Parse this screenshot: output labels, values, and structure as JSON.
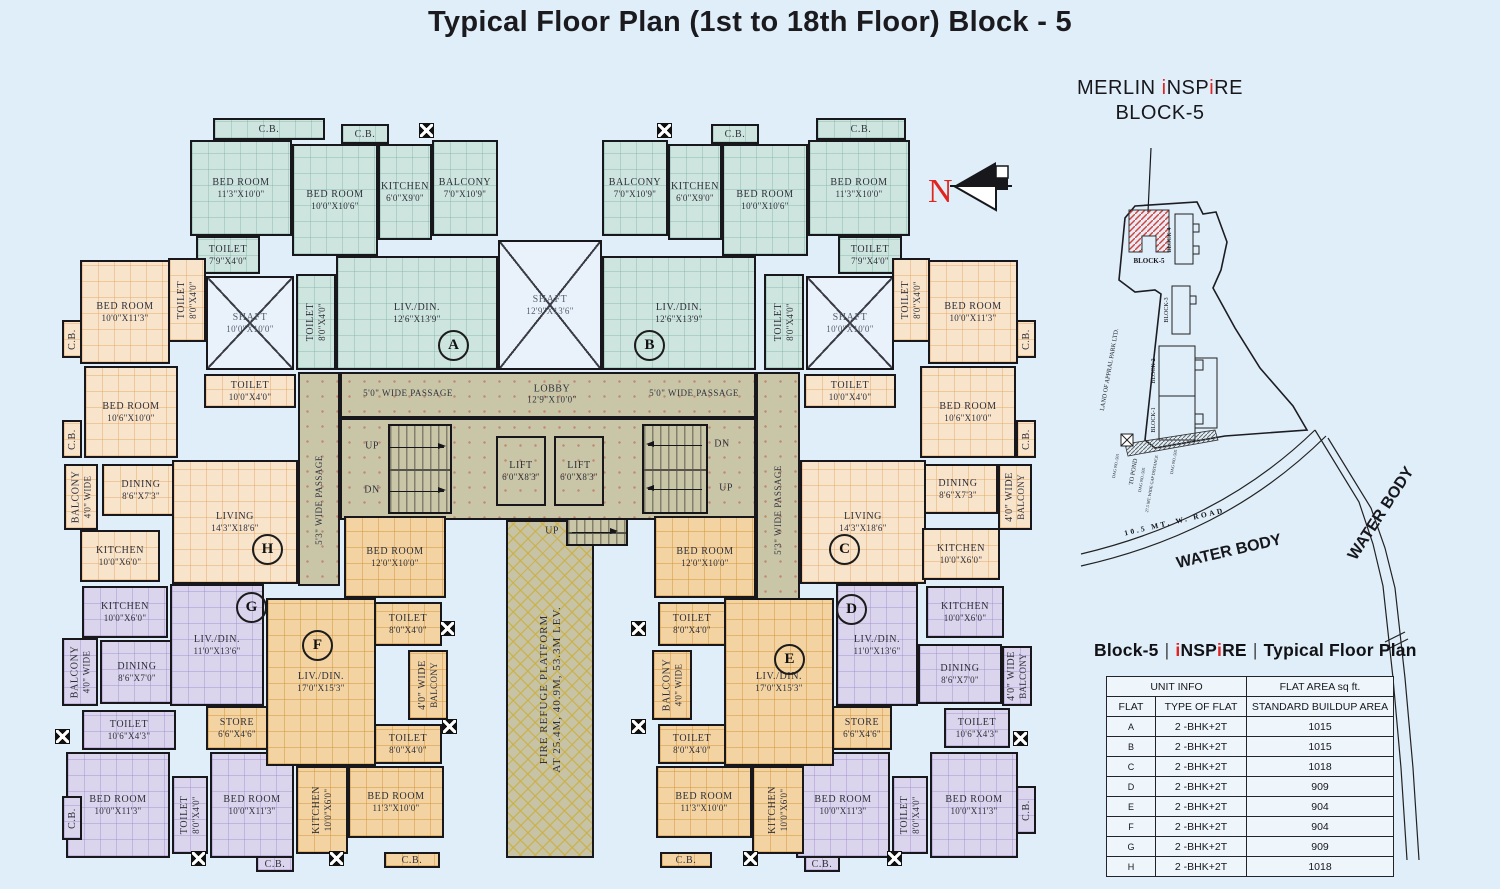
{
  "title": "Typical Floor Plan (1st to 18th Floor) Block - 5",
  "colors": {
    "background": "#dfeef9",
    "flat_ab_teal": "#cde5de",
    "flat_hc_peach": "#f8e4cb",
    "flat_gd_lavender": "#dad4ec",
    "flat_fe_orange": "#f3d3a1",
    "corridor_olive": "#c9c6a8",
    "shaft_blue": "#e9f2fa",
    "wall_black": "#17171c",
    "accent_red": "#e02420"
  },
  "north": {
    "label": "N"
  },
  "project": {
    "name_pre": "MERLIN ",
    "i1": "i",
    "m": "NSP",
    "i2": "i",
    "e": "RE",
    "line2": "BLOCK-5"
  },
  "legend_heading": {
    "left": "Block-5",
    "sep": "|",
    "i1": "i",
    "m": "NSP",
    "i2": "i",
    "e": "RE",
    "right": "Typical Floor Plan"
  },
  "legend_table": {
    "h1a": "UNIT INFO",
    "h1b": "FLAT AREA sq ft.",
    "h2a": "FLAT",
    "h2b": "TYPE OF FLAT",
    "h2c": "STANDARD BUILDUP AREA",
    "rows": [
      {
        "f": "A",
        "t": "2 -BHK+2T",
        "a": "1015"
      },
      {
        "f": "B",
        "t": "2 -BHK+2T",
        "a": "1015"
      },
      {
        "f": "C",
        "t": "2 -BHK+2T",
        "a": "1018"
      },
      {
        "f": "D",
        "t": "2 -BHK+2T",
        "a": "909"
      },
      {
        "f": "E",
        "t": "2 -BHK+2T",
        "a": "904"
      },
      {
        "f": "F",
        "t": "2 -BHK+2T",
        "a": "904"
      },
      {
        "f": "G",
        "t": "2 -BHK+2T",
        "a": "909"
      },
      {
        "f": "H",
        "t": "2 -BHK+2T",
        "a": "1018"
      }
    ]
  },
  "sitemap": {
    "block5": "BLOCK-5",
    "block4": "BLOCK-4",
    "block3": "BLOCK-3",
    "block2": "BLOCK-2",
    "block1": "BLOCK-1",
    "land": "LAND OF APPRAL PARK LTD.",
    "to_pond": "TO POND",
    "dag1": "DAG NO.-501",
    "dag2": "DAG NO.-505",
    "gap": "27.5 MT. WIDE GAP DISTANCE",
    "dag3": "DAG NO.-505",
    "road": "10.5 MT. W. ROAD",
    "water1": "WATER BODY",
    "water2": "WATER BODY"
  },
  "plan": {
    "rooms": [
      {
        "n": "",
        "x": 298,
        "y": 372,
        "w": 42,
        "h": 214,
        "c": "g"
      },
      {
        "n": "",
        "x": 756,
        "y": 372,
        "w": 44,
        "h": 252,
        "c": "g"
      },
      {
        "n": "",
        "x": 340,
        "y": 372,
        "w": 416,
        "h": 46,
        "c": "g"
      },
      {
        "n": "",
        "x": 340,
        "y": 418,
        "w": 416,
        "h": 102,
        "c": "g"
      },
      {
        "n": "FIRE REFUGE PLATFORM",
        "d": "AT 25.4M, 40.9M, 53.3M LEV.",
        "x": 506,
        "y": 520,
        "w": 88,
        "h": 338,
        "c": "fire",
        "v": 1
      },
      {
        "n": "LIFT",
        "d": "6'0\"X8'3\"",
        "x": 496,
        "y": 436,
        "w": 50,
        "h": 70,
        "c": "g"
      },
      {
        "n": "LIFT",
        "d": "6'0\"X8'3\"",
        "x": 554,
        "y": 436,
        "w": 50,
        "h": 70,
        "c": "g"
      },
      {
        "n": "C.B.",
        "x": 213,
        "y": 118,
        "w": 112,
        "h": 22,
        "c": "t"
      },
      {
        "n": "BED ROOM",
        "d": "11'3\"X10'0\"",
        "x": 190,
        "y": 140,
        "w": 102,
        "h": 96,
        "c": "t"
      },
      {
        "n": "C.B.",
        "x": 341,
        "y": 124,
        "w": 48,
        "h": 20,
        "c": "t"
      },
      {
        "n": "BED ROOM",
        "d": "10'0\"X10'6\"",
        "x": 292,
        "y": 144,
        "w": 86,
        "h": 112,
        "c": "t"
      },
      {
        "n": "KITCHEN",
        "d": "6'0\"X9'0\"",
        "x": 378,
        "y": 144,
        "w": 54,
        "h": 96,
        "c": "t"
      },
      {
        "n": "BALCONY",
        "d": "7'0\"X10'9\"",
        "x": 432,
        "y": 140,
        "w": 66,
        "h": 96,
        "c": "t"
      },
      {
        "n": "TOILET",
        "d": "7'9\"X4'0\"",
        "x": 196,
        "y": 236,
        "w": 64,
        "h": 38,
        "c": "t"
      },
      {
        "n": "SHAFT",
        "d": "10'0\"X10'0\"",
        "x": 206,
        "y": 276,
        "w": 88,
        "h": 94,
        "c": "s"
      },
      {
        "n": "TOILET",
        "d": "8'0\"X4'0\"",
        "x": 296,
        "y": 274,
        "w": 40,
        "h": 96,
        "c": "t",
        "v": 1
      },
      {
        "n": "LIV./DIN.",
        "d": "12'6\"X13'9\"",
        "x": 336,
        "y": 256,
        "w": 162,
        "h": 114,
        "c": "t"
      },
      {
        "n": "BALCONY",
        "d": "7'0\"X10'9\"",
        "x": 602,
        "y": 140,
        "w": 66,
        "h": 96,
        "c": "t"
      },
      {
        "n": "KITCHEN",
        "d": "6'0\"X9'0\"",
        "x": 668,
        "y": 144,
        "w": 54,
        "h": 96,
        "c": "t"
      },
      {
        "n": "C.B.",
        "x": 711,
        "y": 124,
        "w": 48,
        "h": 20,
        "c": "t"
      },
      {
        "n": "BED ROOM",
        "d": "10'0\"X10'6\"",
        "x": 722,
        "y": 144,
        "w": 86,
        "h": 112,
        "c": "t"
      },
      {
        "n": "C.B.",
        "x": 816,
        "y": 118,
        "w": 90,
        "h": 22,
        "c": "t"
      },
      {
        "n": "BED ROOM",
        "d": "11'3\"X10'0\"",
        "x": 808,
        "y": 140,
        "w": 102,
        "h": 96,
        "c": "t"
      },
      {
        "n": "TOILET",
        "d": "7'9\"X4'0\"",
        "x": 838,
        "y": 236,
        "w": 64,
        "h": 38,
        "c": "t"
      },
      {
        "n": "SHAFT",
        "d": "10'0\"X10'0\"",
        "x": 806,
        "y": 276,
        "w": 88,
        "h": 94,
        "c": "s"
      },
      {
        "n": "TOILET",
        "d": "8'0\"X4'0\"",
        "x": 764,
        "y": 274,
        "w": 40,
        "h": 96,
        "c": "t",
        "v": 1
      },
      {
        "n": "LIV./DIN.",
        "d": "12'6\"X13'9\"",
        "x": 602,
        "y": 256,
        "w": 154,
        "h": 114,
        "c": "t"
      },
      {
        "n": "SHAFT",
        "d": "12'9\"X13'6\"",
        "x": 498,
        "y": 240,
        "w": 104,
        "h": 130,
        "c": "s"
      },
      {
        "n": "TOILET",
        "d": "8'0\"X4'0\"",
        "x": 168,
        "y": 258,
        "w": 38,
        "h": 84,
        "c": "p",
        "v": 1
      },
      {
        "n": "BED ROOM",
        "d": "10'0\"X11'3\"",
        "x": 80,
        "y": 260,
        "w": 90,
        "h": 104,
        "c": "p"
      },
      {
        "n": "C.B.",
        "x": 62,
        "y": 320,
        "w": 20,
        "h": 38,
        "c": "p",
        "v": 1
      },
      {
        "n": "BED ROOM",
        "d": "10'6\"X10'0\"",
        "x": 84,
        "y": 366,
        "w": 94,
        "h": 92,
        "c": "p"
      },
      {
        "n": "C.B.",
        "x": 62,
        "y": 420,
        "w": 20,
        "h": 38,
        "c": "p",
        "v": 1
      },
      {
        "n": "TOILET",
        "d": "10'0\"X4'0\"",
        "x": 204,
        "y": 374,
        "w": 92,
        "h": 34,
        "c": "p"
      },
      {
        "n": "DINING",
        "d": "8'6\"X7'3\"",
        "x": 102,
        "y": 464,
        "w": 78,
        "h": 52,
        "c": "p"
      },
      {
        "n": "LIVING",
        "d": "14'3\"X18'6\"",
        "x": 172,
        "y": 460,
        "w": 126,
        "h": 124,
        "c": "p"
      },
      {
        "n": "BALCONY",
        "d": "4'0\" WIDE",
        "x": 64,
        "y": 464,
        "w": 34,
        "h": 66,
        "c": "p",
        "v": 1
      },
      {
        "n": "KITCHEN",
        "d": "10'0\"X6'0\"",
        "x": 80,
        "y": 530,
        "w": 80,
        "h": 52,
        "c": "p"
      },
      {
        "n": "TOILET",
        "d": "8'0\"X4'0\"",
        "x": 892,
        "y": 258,
        "w": 38,
        "h": 84,
        "c": "p",
        "v": 1
      },
      {
        "n": "BED ROOM",
        "d": "10'0\"X11'3\"",
        "x": 928,
        "y": 260,
        "w": 90,
        "h": 104,
        "c": "p"
      },
      {
        "n": "C.B.",
        "x": 1016,
        "y": 320,
        "w": 20,
        "h": 38,
        "c": "p",
        "v": 1
      },
      {
        "n": "BED ROOM",
        "d": "10'6\"X10'0\"",
        "x": 920,
        "y": 366,
        "w": 96,
        "h": 92,
        "c": "p"
      },
      {
        "n": "C.B.",
        "x": 1016,
        "y": 420,
        "w": 20,
        "h": 38,
        "c": "p",
        "v": 1
      },
      {
        "n": "TOILET",
        "d": "10'0\"X4'0\"",
        "x": 804,
        "y": 374,
        "w": 92,
        "h": 34,
        "c": "p"
      },
      {
        "n": "DINING",
        "d": "8'6\"X7'3\"",
        "x": 918,
        "y": 464,
        "w": 80,
        "h": 50,
        "c": "p"
      },
      {
        "n": "LIVING",
        "d": "14'3\"X18'6\"",
        "x": 800,
        "y": 460,
        "w": 126,
        "h": 124,
        "c": "p"
      },
      {
        "n": "4'0\" WIDE",
        "d": "BALCONY",
        "x": 998,
        "y": 464,
        "w": 34,
        "h": 66,
        "c": "p",
        "v": 1
      },
      {
        "n": "KITCHEN",
        "d": "10'0\"X6'0\"",
        "x": 922,
        "y": 528,
        "w": 78,
        "h": 52,
        "c": "p"
      },
      {
        "n": "KITCHEN",
        "d": "10'0\"X6'0\"",
        "x": 82,
        "y": 586,
        "w": 86,
        "h": 52,
        "c": "l"
      },
      {
        "n": "BALCONY",
        "d": "4'0\" WIDE",
        "x": 62,
        "y": 638,
        "w": 36,
        "h": 68,
        "c": "l",
        "v": 1
      },
      {
        "n": "DINING",
        "d": "8'6\"X7'0\"",
        "x": 100,
        "y": 640,
        "w": 74,
        "h": 64,
        "c": "l"
      },
      {
        "n": "LIV./DIN.",
        "d": "11'0\"X13'6\"",
        "x": 170,
        "y": 584,
        "w": 94,
        "h": 122,
        "c": "l"
      },
      {
        "n": "TOILET",
        "d": "10'6\"X4'3\"",
        "x": 82,
        "y": 710,
        "w": 94,
        "h": 40,
        "c": "l"
      },
      {
        "n": "BED ROOM",
        "d": "10'0\"X11'3\"",
        "x": 66,
        "y": 752,
        "w": 104,
        "h": 106,
        "c": "l"
      },
      {
        "n": "TOILET",
        "d": "8'0\"X4'0\"",
        "x": 172,
        "y": 776,
        "w": 36,
        "h": 78,
        "c": "l",
        "v": 1
      },
      {
        "n": "BED ROOM",
        "d": "10'0\"X11'3\"",
        "x": 210,
        "y": 752,
        "w": 84,
        "h": 106,
        "c": "l"
      },
      {
        "n": "C.B.",
        "x": 256,
        "y": 856,
        "w": 38,
        "h": 16,
        "c": "l"
      },
      {
        "n": "C.B.",
        "x": 62,
        "y": 796,
        "w": 20,
        "h": 44,
        "c": "l",
        "v": 1
      },
      {
        "n": "KITCHEN",
        "d": "10'0\"X6'0\"",
        "x": 926,
        "y": 586,
        "w": 78,
        "h": 52,
        "c": "l"
      },
      {
        "n": "LIV./DIN.",
        "d": "11'0\"X13'6\"",
        "x": 836,
        "y": 584,
        "w": 82,
        "h": 122,
        "c": "l"
      },
      {
        "n": "DINING",
        "d": "8'6\"X7'0\"",
        "x": 918,
        "y": 644,
        "w": 84,
        "h": 60,
        "c": "l"
      },
      {
        "n": "4'0\" WIDE",
        "d": "BALCONY",
        "x": 1002,
        "y": 646,
        "w": 30,
        "h": 60,
        "c": "l",
        "v": 1
      },
      {
        "n": "TOILET",
        "d": "10'6\"X4'3\"",
        "x": 944,
        "y": 708,
        "w": 66,
        "h": 40,
        "c": "l"
      },
      {
        "n": "BED ROOM",
        "d": "10'0\"X11'3\"",
        "x": 796,
        "y": 752,
        "w": 94,
        "h": 106,
        "c": "l"
      },
      {
        "n": "TOILET",
        "d": "8'0\"X4'0\"",
        "x": 892,
        "y": 776,
        "w": 36,
        "h": 78,
        "c": "l",
        "v": 1
      },
      {
        "n": "BED ROOM",
        "d": "10'0\"X11'3\"",
        "x": 930,
        "y": 752,
        "w": 88,
        "h": 106,
        "c": "l"
      },
      {
        "n": "C.B.",
        "x": 1016,
        "y": 786,
        "w": 20,
        "h": 48,
        "c": "l",
        "v": 1
      },
      {
        "n": "C.B.",
        "x": 804,
        "y": 856,
        "w": 36,
        "h": 16,
        "c": "l"
      },
      {
        "n": "BED ROOM",
        "d": "12'0\"X10'0\"",
        "x": 344,
        "y": 516,
        "w": 102,
        "h": 82,
        "c": "o"
      },
      {
        "n": "TOILET",
        "d": "8'0\"X4'0\"",
        "x": 374,
        "y": 602,
        "w": 68,
        "h": 44,
        "c": "o"
      },
      {
        "n": "4'0\" WIDE",
        "d": "BALCONY",
        "x": 408,
        "y": 650,
        "w": 40,
        "h": 70,
        "c": "o",
        "v": 1
      },
      {
        "n": "TOILET",
        "d": "8'0\"X4'0\"",
        "x": 374,
        "y": 724,
        "w": 68,
        "h": 40,
        "c": "o"
      },
      {
        "n": "LIV./DIN.",
        "d": "17'0\"X15'3\"",
        "x": 266,
        "y": 598,
        "w": 110,
        "h": 168,
        "c": "o"
      },
      {
        "n": "STORE",
        "d": "6'6\"X4'6\"",
        "x": 206,
        "y": 706,
        "w": 62,
        "h": 44,
        "c": "o"
      },
      {
        "n": "KITCHEN",
        "d": "10'0\"X6'0\"",
        "x": 296,
        "y": 766,
        "w": 52,
        "h": 88,
        "c": "o",
        "v": 1
      },
      {
        "n": "BED ROOM",
        "d": "11'3\"X10'0\"",
        "x": 348,
        "y": 766,
        "w": 96,
        "h": 72,
        "c": "o"
      },
      {
        "n": "C.B.",
        "x": 384,
        "y": 852,
        "w": 56,
        "h": 16,
        "c": "o"
      },
      {
        "n": "BED ROOM",
        "d": "12'0\"X10'0\"",
        "x": 654,
        "y": 516,
        "w": 102,
        "h": 82,
        "c": "o"
      },
      {
        "n": "TOILET",
        "d": "8'0\"X4'0\"",
        "x": 658,
        "y": 602,
        "w": 68,
        "h": 44,
        "c": "o"
      },
      {
        "n": "BALCONY",
        "d": "4'0\" WIDE",
        "x": 652,
        "y": 650,
        "w": 40,
        "h": 70,
        "c": "o",
        "v": 1
      },
      {
        "n": "TOILET",
        "d": "8'0\"X4'0\"",
        "x": 658,
        "y": 724,
        "w": 68,
        "h": 40,
        "c": "o"
      },
      {
        "n": "LIV./DIN.",
        "d": "17'0\"X15'3\"",
        "x": 724,
        "y": 598,
        "w": 110,
        "h": 168,
        "c": "o"
      },
      {
        "n": "STORE",
        "d": "6'6\"X4'6\"",
        "x": 832,
        "y": 706,
        "w": 60,
        "h": 44,
        "c": "o"
      },
      {
        "n": "KITCHEN",
        "d": "10'0\"X6'0\"",
        "x": 752,
        "y": 766,
        "w": 52,
        "h": 88,
        "c": "o",
        "v": 1
      },
      {
        "n": "BED ROOM",
        "d": "11'3\"X10'0\"",
        "x": 656,
        "y": 766,
        "w": 96,
        "h": 72,
        "c": "o"
      },
      {
        "n": "C.B.",
        "x": 660,
        "y": 852,
        "w": 52,
        "h": 16,
        "c": "o"
      }
    ],
    "texts": [
      {
        "t": "LOBBY",
        "d": "12'9\"X10'0\"",
        "x": 552,
        "y": 394
      },
      {
        "t": "5'0\" WIDE PASSAGE",
        "x": 408,
        "y": 393,
        "fs": 9
      },
      {
        "t": "5'0\" WIDE PASSAGE",
        "x": 694,
        "y": 393,
        "fs": 9
      },
      {
        "t": "5'3\" WIDE PASSAGE",
        "x": 319,
        "y": 500,
        "v": 1,
        "fs": 9
      },
      {
        "t": "5'3\" WIDE PASSAGE",
        "x": 778,
        "y": 510,
        "v": 1,
        "fs": 9
      },
      {
        "t": "UP",
        "x": 552,
        "y": 531,
        "fs": 10
      },
      {
        "t": "UP",
        "x": 372,
        "y": 446,
        "fs": 10
      },
      {
        "t": "DN",
        "x": 372,
        "y": 490,
        "fs": 10
      },
      {
        "t": "DN",
        "x": 722,
        "y": 444,
        "fs": 10
      },
      {
        "t": "UP",
        "x": 726,
        "y": 488,
        "fs": 10
      }
    ],
    "marks": [
      {
        "t": "A",
        "x": 452,
        "y": 344
      },
      {
        "t": "B",
        "x": 648,
        "y": 344
      },
      {
        "t": "C",
        "x": 843,
        "y": 548
      },
      {
        "t": "D",
        "x": 850,
        "y": 608
      },
      {
        "t": "E",
        "x": 788,
        "y": 658
      },
      {
        "t": "F",
        "x": 316,
        "y": 644
      },
      {
        "t": "G",
        "x": 250,
        "y": 606
      },
      {
        "t": "H",
        "x": 266,
        "y": 548
      }
    ],
    "stairs": [
      {
        "x": 388,
        "y": 424,
        "w": 64,
        "h": 90
      },
      {
        "x": 642,
        "y": 424,
        "w": 66,
        "h": 90
      },
      {
        "x": 566,
        "y": 518,
        "w": 62,
        "h": 28
      }
    ],
    "arrows": [
      {
        "x": 390,
        "y": 447,
        "w": 54,
        "dir": "r"
      },
      {
        "x": 390,
        "y": 491,
        "w": 54,
        "dir": "r"
      },
      {
        "x": 648,
        "y": 445,
        "w": 54,
        "dir": "l"
      },
      {
        "x": 648,
        "y": 489,
        "w": 54,
        "dir": "l"
      },
      {
        "x": 572,
        "y": 532,
        "w": 44,
        "dir": "r"
      }
    ],
    "xmarks": [
      [
        426,
        130
      ],
      [
        664,
        130
      ],
      [
        62,
        736
      ],
      [
        1020,
        738
      ],
      [
        447,
        628
      ],
      [
        449,
        726
      ],
      [
        638,
        628
      ],
      [
        638,
        726
      ],
      [
        198,
        858
      ],
      [
        336,
        858
      ],
      [
        750,
        858
      ],
      [
        894,
        858
      ]
    ]
  }
}
